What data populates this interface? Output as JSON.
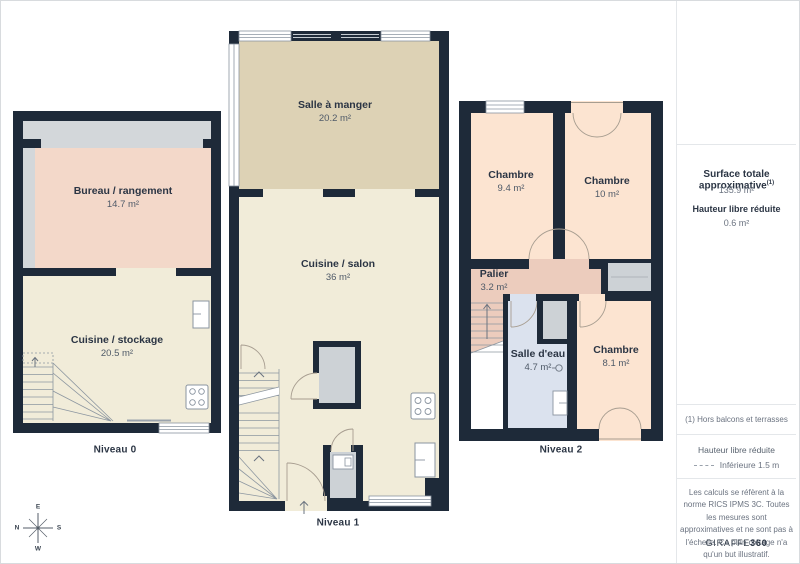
{
  "floors": [
    {
      "label": "Niveau 0",
      "rooms": [
        {
          "name": "Bureau / rangement",
          "area": "14.7 m²"
        },
        {
          "name": "Cuisine / stockage",
          "area": "20.5 m²"
        }
      ]
    },
    {
      "label": "Niveau 1",
      "rooms": [
        {
          "name": "Salle à manger",
          "area": "20.2 m²"
        },
        {
          "name": "Cuisine / salon",
          "area": "36 m²"
        }
      ]
    },
    {
      "label": "Niveau 2",
      "rooms": [
        {
          "name": "Chambre",
          "area": "9.4 m²"
        },
        {
          "name": "Chambre",
          "area": "10 m²"
        },
        {
          "name": "Palier",
          "area": "3.2 m²"
        },
        {
          "name": "Salle d'eau",
          "area": "4.7 m²"
        },
        {
          "name": "Chambre",
          "area": "8.1 m²"
        }
      ]
    }
  ],
  "sidebar": {
    "surface_title": "Surface totale approximative",
    "surface_sup": "(1)",
    "surface_value": "135.9 m²",
    "reduced_height_title": "Hauteur libre réduite",
    "reduced_height_value": "0.6 m²",
    "footnote": "(1) Hors balcons et terrasses",
    "legend_title": "Hauteur libre réduite",
    "legend_label": "Inférieure 1.5 m",
    "legend_swatch": "dashed-line",
    "disclaimer": "Les calculs se réfèrent à la norme RICS IPMS 3C. Toutes les mesures sont approximatives et ne sont pas à l'échelle. Ce plan d'étage n'a qu'un but illustratif.",
    "brand_regular": "GIRAFFE",
    "brand_bold": "360"
  },
  "compass": {
    "top": "E",
    "right": "S",
    "bottom": "W",
    "left": "N"
  },
  "colors": {
    "wall": "#1e2a39",
    "floor_cream": "#f1ecd9",
    "floor_tan": "#ddd2b5",
    "floor_pink": "#f3d8c9",
    "floor_peach": "#fce4d1",
    "floor_palier": "#ecccbd",
    "floor_blue": "#dbe2ee",
    "gray_zone": "#d3d7da",
    "door_line": "#a79d90"
  }
}
